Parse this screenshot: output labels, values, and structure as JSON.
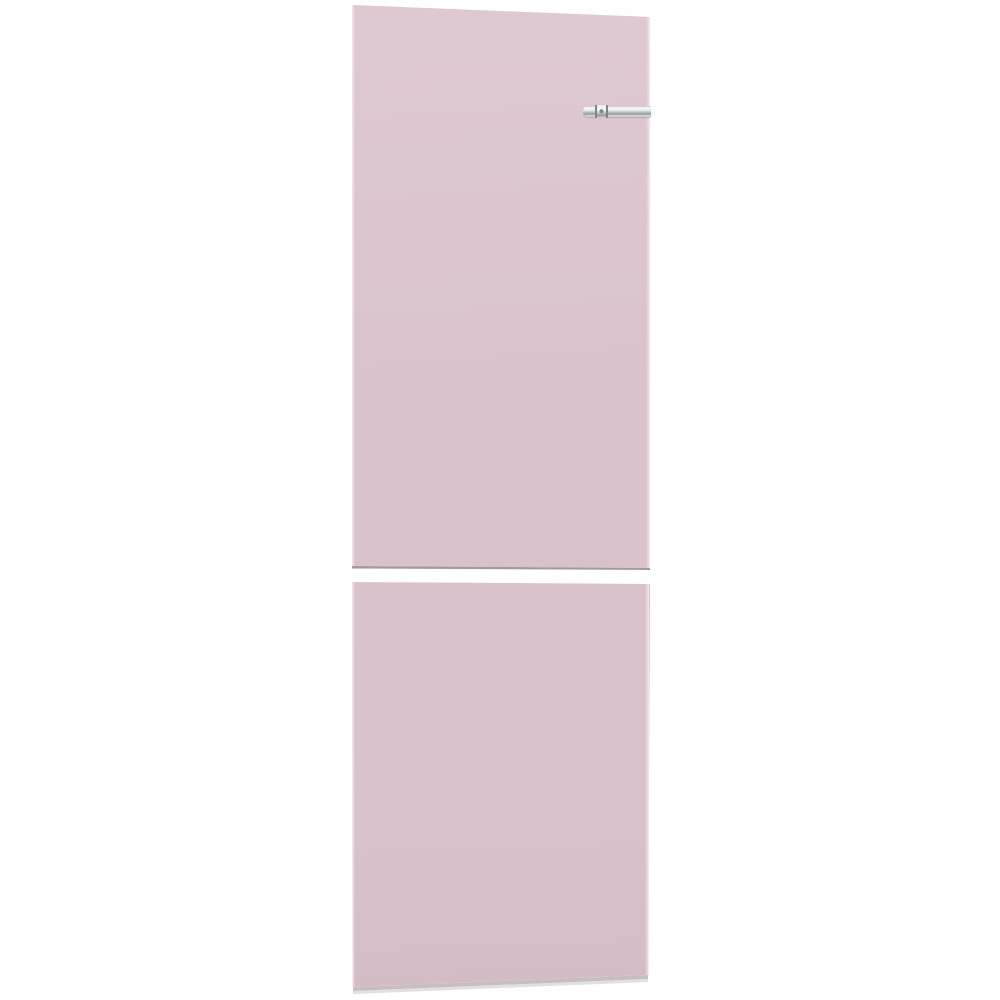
{
  "scene": {
    "type": "product photograph",
    "subject": "pastel pink clip-on refrigerator door panel set (two panels) with chrome handle strip",
    "background": "plain white"
  },
  "product": {
    "parts": {
      "upper_panel": "upper door panel",
      "lower_panel": "lower door panel",
      "handle_strip": "chrome handle strip",
      "handle_bracket": "handle mounting bracket"
    }
  },
  "colors": {
    "background": "#ffffff",
    "panel_pink": "#d9c2cc",
    "panel_pink_light": "#dfc9d2",
    "panel_pink_dark": "#d3bbc5",
    "panel_edge_line": "#a39aa0",
    "panel_bottom_edge": "#c5bfc2",
    "panel_shadow": "#e3dfe1",
    "edge_sheen": "#f3e9ee",
    "chrome_highlight": "#f7f8f9",
    "chrome_light": "#e9ebec",
    "chrome_mid": "#c0c4c8",
    "chrome_dark": "#94989d",
    "chrome_base": "#d9dbdd",
    "chrome_outline": "#7f8388"
  }
}
